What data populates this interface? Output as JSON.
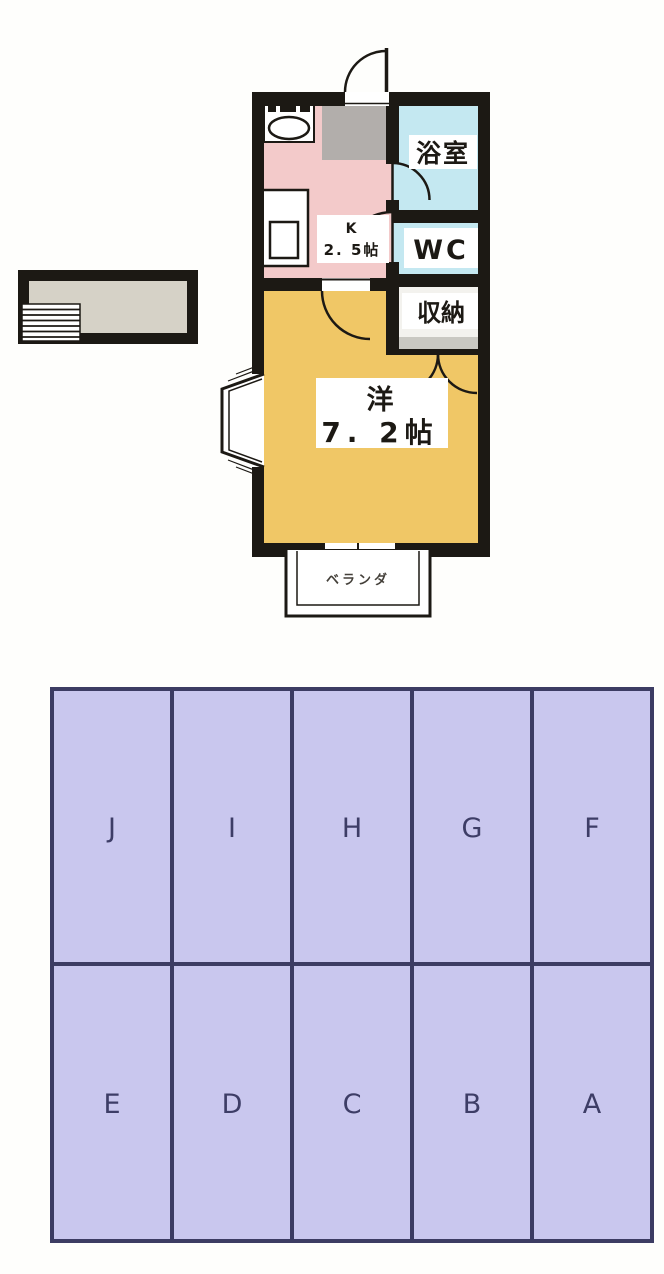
{
  "floor_plan": {
    "rooms": {
      "bathroom": "浴室",
      "toilet": "WC",
      "closet": "収納",
      "kitchen_type": "K",
      "kitchen_size": "2. 5帖",
      "main_room_type": "洋",
      "main_room_size": "7. 2帖",
      "balcony": "ベランダ"
    },
    "colors": {
      "wall": "#1c1914",
      "kitchen_floor": "#f3caca",
      "entrance_floor": "#b2aeab",
      "wet_area_floor": "#c4e8f1",
      "main_room_floor": "#f0c766",
      "closet_floor": "#f3f2ee",
      "closet_shelf": "#c9c8c2",
      "annex_floor": "#d6d2c7"
    }
  },
  "parking": {
    "top_row": [
      "J",
      "I",
      "H",
      "G",
      "F"
    ],
    "bottom_row": [
      "E",
      "D",
      "C",
      "B",
      "A"
    ],
    "space_fill": "#c9c7ee",
    "line_color": "#3c3c63",
    "label_color": "#3d3d66"
  }
}
